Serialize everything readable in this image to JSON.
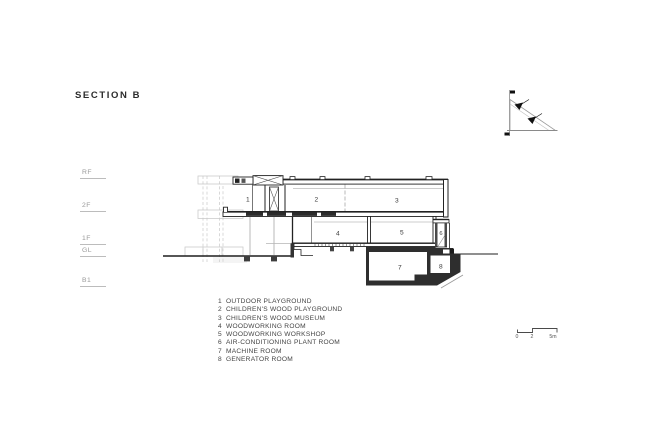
{
  "title": "SECTION B",
  "levels": [
    {
      "label": "RF"
    },
    {
      "label": "2F"
    },
    {
      "label": "1F"
    },
    {
      "label": "GL"
    },
    {
      "label": "B1"
    }
  ],
  "rooms": [
    {
      "num": "1"
    },
    {
      "num": "2"
    },
    {
      "num": "3"
    },
    {
      "num": "4"
    },
    {
      "num": "5"
    },
    {
      "num": "6"
    },
    {
      "num": "7"
    },
    {
      "num": "8"
    }
  ],
  "legend": {
    "items": [
      {
        "num": "1",
        "label": "OUTDOOR PLAYGROUND"
      },
      {
        "num": "2",
        "label": "CHILDREN'S WOOD PLAYGROUND"
      },
      {
        "num": "3",
        "label": "CHILDREN'S WOOD MUSEUM"
      },
      {
        "num": "4",
        "label": "WOODWORKING ROOM"
      },
      {
        "num": "5",
        "label": "WOODWORKING WORKSHOP"
      },
      {
        "num": "6",
        "label": "AIR-CONDITIONING PLANT ROOM"
      },
      {
        "num": "7",
        "label": "MACHINE ROOM"
      },
      {
        "num": "8",
        "label": "GENERATOR ROOM"
      }
    ]
  },
  "scale_bar": {
    "labels": [
      "0",
      "2",
      "5m"
    ]
  },
  "colors": {
    "ink": "#222222",
    "mid_gray": "#8c8c8c",
    "light_gray": "#c6c6c6",
    "background": "#ffffff"
  }
}
